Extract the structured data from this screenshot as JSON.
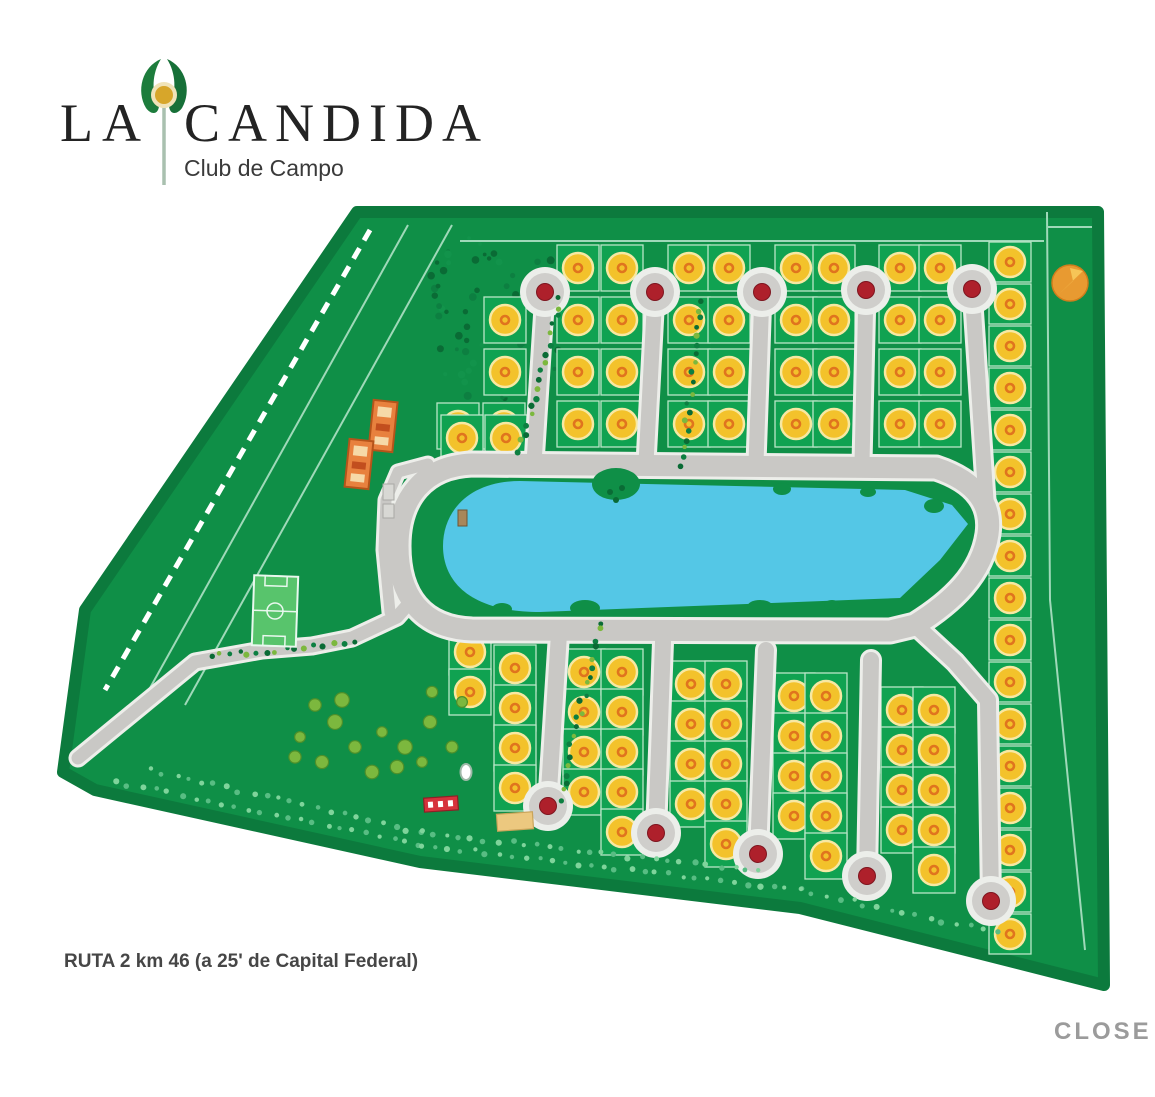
{
  "logo": {
    "la": "LA",
    "candida": "CANDIDA",
    "subtitle": "Club de Campo"
  },
  "footer": {
    "route_text": "RUTA 2 km 46 (a 25' de Capital Federal)"
  },
  "lightbox": {
    "close_label": "CLOSE"
  },
  "map": {
    "colors": {
      "base": "#0f8f47",
      "border_dark": "#0c7a3d",
      "cell": "#10a251",
      "cell_line": "#b9e6c8",
      "road": "#c9c8c5",
      "road_edge": "#edeeea",
      "bulb_ring": "#eceeea",
      "bulb_disc": "#cfcecb",
      "bulb_center": "#ae202b",
      "lake": "#54c7e6",
      "lot_fill": "#f3c22b",
      "lot_ring": "#f7e8a2",
      "lot_mark": "#e0741e",
      "forest": "#0a6b35",
      "forest2": "#0d7f41",
      "forest3": "#12934b",
      "tree_light": "#7fd49b",
      "tree_mid": "#58bd83",
      "cluster": "#7cb83e",
      "cluster_dark": "#4e8f2a",
      "building": "#e8813e",
      "building_dark": "#b5541a",
      "building_light": "#f6d9a8",
      "field": "#58c46c",
      "compass": "#e89a31",
      "compass_arrow": "#f6c557",
      "compass_edge": "#d07d1c",
      "line_light": "#9fd9b9",
      "dash_white": "#ffffff",
      "pier": "#a8875a",
      "pier_edge": "#6f5533",
      "red_court": "#d6323c",
      "red_court_edge": "#8f1f26",
      "sand_court": "#ecc87f",
      "sand_court_edge": "#c9a45a"
    },
    "outline": [
      [
        357,
        212
      ],
      [
        1098,
        212
      ],
      [
        1104,
        985
      ],
      [
        800,
        908
      ],
      [
        420,
        862
      ],
      [
        95,
        790
      ],
      [
        63,
        772
      ],
      [
        85,
        610
      ]
    ],
    "dashed_line": [
      [
        370,
        230
      ],
      [
        105,
        690
      ]
    ],
    "thin_lines": [
      [
        [
          408,
          225
        ],
        [
          150,
          688
        ]
      ],
      [
        [
          452,
          225
        ],
        [
          185,
          705
        ]
      ],
      [
        [
          1047,
          212
        ],
        [
          1050,
          600
        ],
        [
          1085,
          950
        ]
      ],
      [
        [
          1047,
          227
        ],
        [
          1092,
          227
        ]
      ],
      [
        [
          460,
          241
        ],
        [
          1044,
          241
        ]
      ]
    ],
    "ring_road": "M 472,464 L 936,468 C 978,482 992,506 988,534 C 982,574 952,602 915,625 L 890,631 L 472,630 C 420,628 398,594 398,546 C 398,498 424,466 472,464 Z",
    "roads": [
      {
        "pts": [
          [
            915,
            625
          ],
          [
            955,
            662
          ],
          [
            988,
            700
          ]
        ],
        "w": 16
      },
      {
        "pts": [
          [
            78,
            758
          ],
          [
            195,
            662
          ],
          [
            262,
            650
          ],
          [
            312,
            646
          ],
          [
            352,
            638
          ],
          [
            397,
            617
          ],
          [
            412,
            600
          ]
        ],
        "w": 13
      },
      {
        "pts": [
          [
            390,
            612
          ],
          [
            384,
            550
          ],
          [
            386,
            500
          ],
          [
            398,
            472
          ],
          [
            428,
            464
          ]
        ],
        "w": 11
      }
    ],
    "streets": [
      {
        "pts": [
          [
            545,
            292
          ],
          [
            534,
            463
          ]
        ],
        "w": 15,
        "bulb": 0
      },
      {
        "pts": [
          [
            655,
            292
          ],
          [
            646,
            463
          ]
        ],
        "w": 15,
        "bulb": 0
      },
      {
        "pts": [
          [
            762,
            292
          ],
          [
            756,
            463
          ]
        ],
        "w": 15,
        "bulb": 0
      },
      {
        "pts": [
          [
            866,
            290
          ],
          [
            862,
            463
          ]
        ],
        "w": 15,
        "bulb": 0
      },
      {
        "pts": [
          [
            972,
            289
          ],
          [
            986,
            500
          ]
        ],
        "w": 15,
        "bulb": 0
      },
      {
        "pts": [
          [
            559,
            634
          ],
          [
            548,
            806
          ]
        ],
        "w": 16,
        "bulb": 1
      },
      {
        "pts": [
          [
            663,
            642
          ],
          [
            656,
            833
          ]
        ],
        "w": 16,
        "bulb": 1
      },
      {
        "pts": [
          [
            766,
            650
          ],
          [
            758,
            854
          ]
        ],
        "w": 16,
        "bulb": 1
      },
      {
        "pts": [
          [
            871,
            660
          ],
          [
            867,
            876
          ]
        ],
        "w": 16,
        "bulb": 1
      },
      {
        "pts": [
          [
            988,
            702
          ],
          [
            991,
            901
          ]
        ],
        "w": 16,
        "bulb": 1
      }
    ],
    "lot_groups": [
      {
        "cols": [
          578,
          622
        ],
        "rows": [
          268,
          320,
          372,
          424
        ]
      },
      {
        "cols": [
          689,
          729
        ],
        "rows": [
          268,
          320,
          372,
          424
        ]
      },
      {
        "cols": [
          796,
          834
        ],
        "rows": [
          268,
          320,
          372,
          424
        ]
      },
      {
        "cols": [
          900,
          940
        ],
        "rows": [
          268,
          320,
          372,
          424
        ]
      },
      {
        "cols": [
          505
        ],
        "rows": [
          320,
          372
        ]
      },
      {
        "cols": [
          458,
          504
        ],
        "rows": [
          426
        ]
      },
      {
        "cols": [
          462,
          506
        ],
        "rows": [
          438
        ]
      },
      {
        "cols": [
          1010
        ],
        "rows": [
          262,
          304,
          346,
          388,
          430,
          472,
          514,
          556,
          598,
          640,
          682,
          724,
          766,
          808,
          850,
          892,
          934
        ],
        "cellH": 40
      },
      {
        "cols": [
          470
        ],
        "rows": [
          652,
          692
        ]
      },
      {
        "cols": [
          515
        ],
        "rows": [
          668,
          708,
          748,
          788
        ]
      },
      {
        "cols": [
          584,
          622
        ],
        "rows": [
          672,
          712,
          752,
          792
        ]
      },
      {
        "cols": [
          622
        ],
        "rows": [
          832
        ]
      },
      {
        "cols": [
          691,
          726
        ],
        "rows": [
          684,
          724,
          764,
          804
        ]
      },
      {
        "cols": [
          726
        ],
        "rows": [
          844
        ]
      },
      {
        "cols": [
          794,
          826
        ],
        "rows": [
          696,
          736,
          776,
          816
        ]
      },
      {
        "cols": [
          826
        ],
        "rows": [
          856
        ]
      },
      {
        "cols": [
          902,
          934
        ],
        "rows": [
          710,
          750,
          790,
          830
        ]
      },
      {
        "cols": [
          934
        ],
        "rows": [
          870
        ]
      }
    ],
    "lake": {
      "path": "M 520,481 L 905,490 L 952,505 L 968,524 L 940,560 L 900,598 L 540,612 C 468,612 443,580 443,546 C 443,512 468,481 520,481 Z",
      "bumps": [
        [
          616,
          484,
          24,
          16
        ],
        [
          782,
          489,
          9,
          6
        ],
        [
          868,
          492,
          8,
          5
        ],
        [
          585,
          608,
          15,
          8
        ],
        [
          760,
          607,
          13,
          7
        ],
        [
          832,
          605,
          8,
          5
        ],
        [
          934,
          506,
          10,
          7
        ],
        [
          502,
          609,
          10,
          6
        ]
      ],
      "islet_dots": [
        [
          610,
          492
        ],
        [
          622,
          488
        ],
        [
          616,
          500
        ]
      ],
      "pier": [
        458,
        510,
        9,
        16
      ]
    },
    "forest": {
      "cx": 497,
      "cy": 315,
      "rx": 78,
      "ry": 88,
      "n": 80
    },
    "hedges": [
      [
        [
          560,
          300
        ],
        [
          520,
          450
        ]
      ],
      [
        [
          700,
          300
        ],
        [
          682,
          468
        ]
      ],
      [
        [
          600,
          622
        ],
        [
          560,
          800
        ]
      ],
      [
        [
          212,
          657
        ],
        [
          352,
          641
        ]
      ]
    ],
    "tree_rows": [
      [
        [
          115,
          782
        ],
        [
          420,
          845
        ],
        [
          800,
          890
        ],
        [
          995,
          932
        ]
      ],
      [
        [
          150,
          770
        ],
        [
          420,
          832
        ],
        [
          760,
          872
        ]
      ]
    ],
    "clusters": [
      [
        315,
        705
      ],
      [
        335,
        722
      ],
      [
        300,
        737
      ],
      [
        355,
        747
      ],
      [
        322,
        762
      ],
      [
        382,
        732
      ],
      [
        405,
        747
      ],
      [
        430,
        722
      ],
      [
        372,
        772
      ],
      [
        342,
        700
      ],
      [
        397,
        767
      ],
      [
        422,
        762
      ],
      [
        452,
        747
      ],
      [
        295,
        757
      ],
      [
        432,
        692
      ],
      [
        462,
        702
      ]
    ],
    "buildings": [
      {
        "x": 371,
        "y": 401,
        "w": 24,
        "h": 50,
        "rot": 6
      },
      {
        "x": 347,
        "y": 440,
        "w": 24,
        "h": 48,
        "rot": 6
      }
    ],
    "gatehouse": [
      [
        383,
        484,
        11,
        16
      ],
      [
        383,
        504,
        11,
        14
      ]
    ],
    "soccer_field": {
      "x": 253,
      "y": 576,
      "w": 44,
      "h": 70,
      "rot": 2
    },
    "amenities": {
      "red_court": [
        424,
        797,
        34,
        14,
        -4
      ],
      "sand_court": [
        497,
        813,
        36,
        17,
        -4
      ],
      "white_oval": [
        466,
        772
      ]
    },
    "compass": {
      "cx": 1070,
      "cy": 283,
      "r": 18
    }
  }
}
